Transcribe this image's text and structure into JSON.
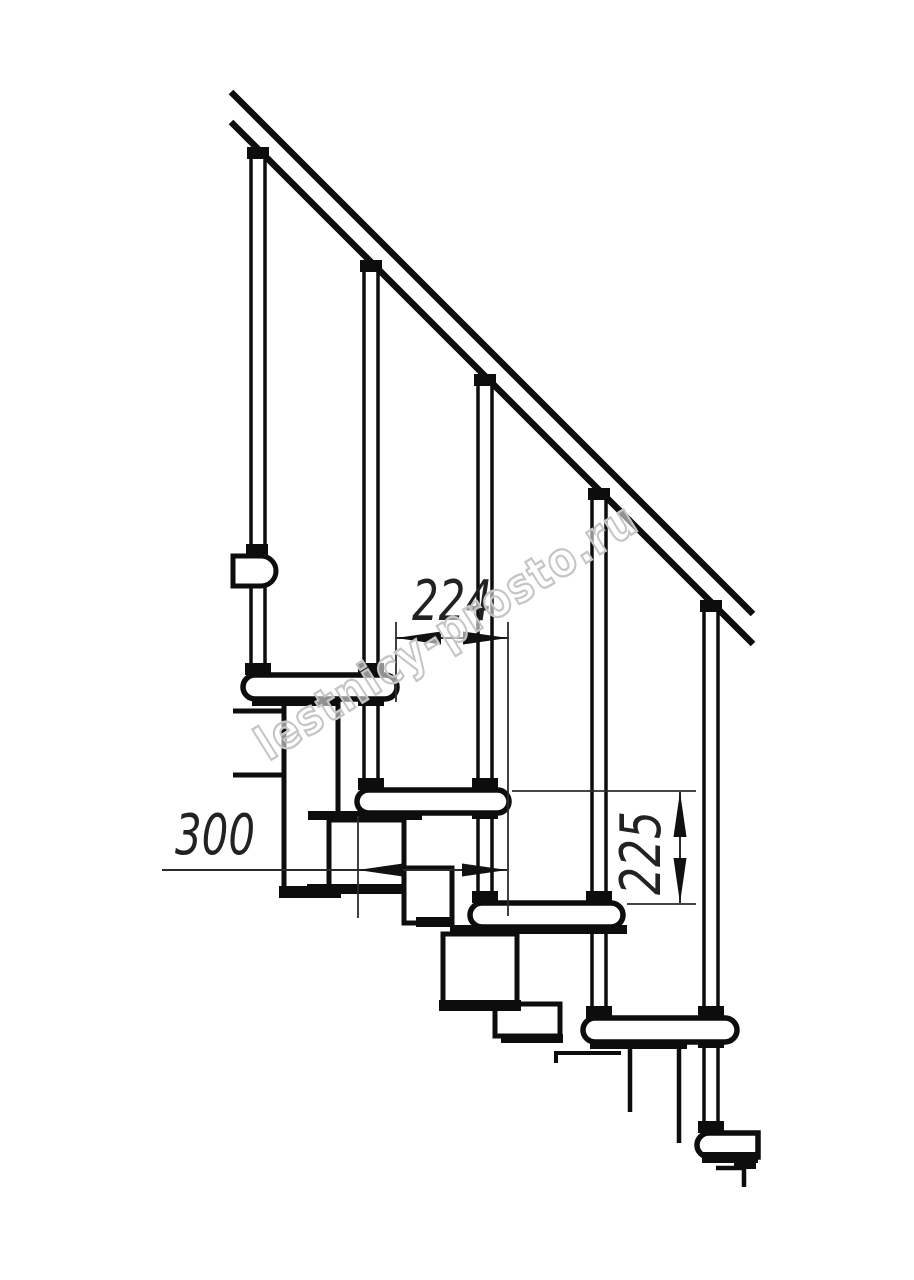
{
  "drawing": {
    "background": "#ffffff",
    "stroke_color": "#0d0d0d",
    "dimension_color": "#2b2b2b",
    "annotations": {
      "step_offset_mm": "224",
      "tread_depth_mm": "300",
      "riser_height_mm": "225"
    },
    "watermark": {
      "text": "lestnicy-prosto.ru",
      "outline_color": "#c5c5c5"
    }
  }
}
